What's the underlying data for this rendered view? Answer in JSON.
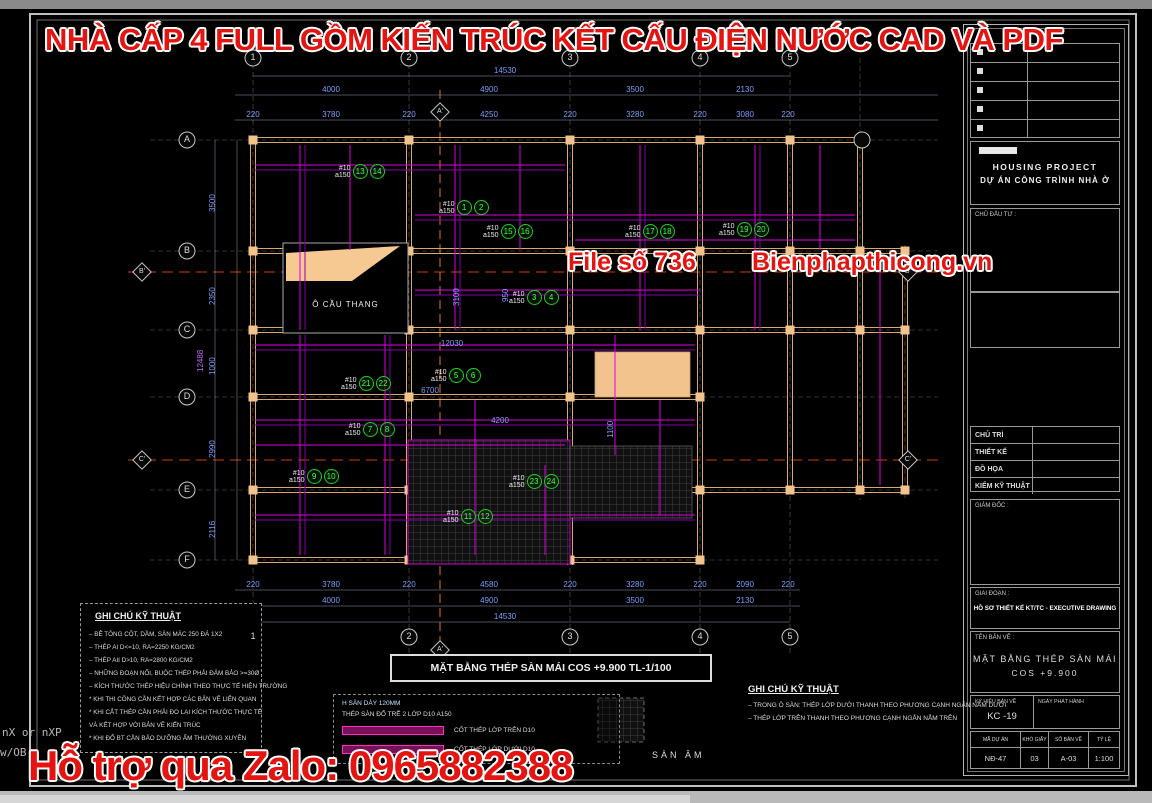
{
  "overlay": {
    "top_banner": "NHÀ CẤP 4 FULL GỒM KIẾN TRÚC KẾT CẤU ĐIỆN NƯỚC CAD VÀ PDF",
    "file_no": "File số 736",
    "website": "Bienphapthicong.vn",
    "zalo": "Hỗ trợ qua Zalo: 0965882388",
    "accent_red": "#e41410"
  },
  "terminal": {
    "line1": "nX or nXP",
    "line2": "w/OB"
  },
  "grid": {
    "cols": [
      "1",
      "2",
      "3",
      "4",
      "5"
    ],
    "rows": [
      "A",
      "B",
      "C",
      "D",
      "E",
      "F"
    ],
    "aux_col": "A'",
    "aux_rows": [
      "B'",
      "C'"
    ]
  },
  "dims": {
    "top_total": "14530",
    "top_spans": [
      "4000",
      "4900",
      "3500",
      "2130"
    ],
    "top_subs": [
      "220",
      "3780",
      "220",
      "4250",
      "220",
      "3280",
      "220",
      "3080",
      "220"
    ],
    "bottom_total": "14530",
    "bottom_spans": [
      "4000",
      "4900",
      "3500",
      "2130"
    ],
    "bottom_subs": [
      "220",
      "3780",
      "220",
      "4580",
      "220",
      "3280",
      "220",
      "2090",
      "220"
    ],
    "left_total": "12488",
    "left_spans": [
      "3500",
      "2350",
      "1000",
      "2990",
      "2116"
    ],
    "interior": [
      "12030",
      "6700",
      "4200",
      "1100",
      "3100",
      "950"
    ]
  },
  "callouts": {
    "bar": "#10",
    "spacing": "a150",
    "items": [
      {
        "a": "13",
        "b": "14"
      },
      {
        "a": "1",
        "b": "2"
      },
      {
        "a": "15",
        "b": "16"
      },
      {
        "a": "17",
        "b": "18"
      },
      {
        "a": "19",
        "b": "20"
      },
      {
        "a": "3",
        "b": "4"
      },
      {
        "a": "21",
        "b": "22"
      },
      {
        "a": "5",
        "b": "6"
      },
      {
        "a": "7",
        "b": "8"
      },
      {
        "a": "9",
        "b": "10"
      },
      {
        "a": "23",
        "b": "24"
      },
      {
        "a": "11",
        "b": "12"
      }
    ]
  },
  "plan": {
    "title": "MẶT BẰNG  THÉP  SÀN MÁI   COS +9.900    TL-1/100",
    "stair_label": "Ô CẦU THANG",
    "sunken_label": "SÀN  ÂM"
  },
  "legend": {
    "line1": "H SÀN DÀY 120MM",
    "line2": "THÉP SÀN ĐỔ TRỄ 2 LỚP D10 A150",
    "top_layer": "CỐT THÉP LỚP TRÊN D10",
    "bottom_layer": "CỐT THÉP LỚP DƯỚI D10"
  },
  "notes_left": {
    "title": "GHI CHÚ KỸ THUẬT",
    "lines": [
      "– BÊ TÔNG CỘT, DẦM, SÀN MÁC 250 ĐÁ 1X2",
      "– THÉP AI D<=10, RA=2250 KG/CM2",
      "– THÉP AII D>10, RA=2800 KG/CM2",
      "– NHỮNG ĐOẠN NỐI, BUỘC THÉP PHẢI ĐẢM BẢO >=30Ø",
      "– KÍCH THƯỚC THÉP HIỆU CHỈNH THEO THỰC TẾ HIỆN TRƯỜNG",
      "* KHI THI CÔNG CẦN KẾT HỢP CÁC BẢN VẼ LIÊN QUAN",
      "* KHI CẮT THÉP CẦN PHẢI ĐO LẠI KÍCH THƯỚC THỰC TẾ",
      "   VÀ KẾT HỢP VỚI BẢN VẼ KIẾN TRÚC",
      "* KHI ĐỔ BT CẦN BẢO DƯỠNG ẨM THƯỜNG XUYÊN"
    ]
  },
  "notes_right": {
    "title": "GHI CHÚ KỸ THUẬT",
    "lines": [
      "– TRONG Ô SÀN: THÉP LỚP DƯỚI THANH THEO PHƯƠNG CẠNH NGẮN NẰM DƯỚI",
      "– THÉP LỚP TRÊN THANH THEO PHƯƠNG CẠNH NGẮN NẰM TRÊN"
    ]
  },
  "titleblock": {
    "project_en": "HOUSING PROJECT",
    "project_vi": "DỰ ÁN CÔNG TRÌNH NHÀ Ở",
    "client": "CHỦ ĐẦU TƯ :",
    "roles": [
      "CHỦ TRÌ",
      "THIẾT KẾ",
      "ĐỒ HỌA",
      "KIỂM KỸ THUẬT"
    ],
    "director": "GIÁM ĐỐC :",
    "stage_label": "GIAI ĐOẠN :",
    "stage": "HỒ SƠ THIẾT KẾ KT/TC - EXECUTIVE DRAWING",
    "sheet_label": "TÊN BẢN VẼ :",
    "sheet_name": "MẶT BẰNG THÉP SÀN MÁI",
    "sheet_cos": "COS +9.900",
    "code_label": "KÝ HIỆU BẢN VẼ",
    "code": "KC -19",
    "date_label": "NGÀY PHÁT HÀNH",
    "footer": [
      {
        "label": "MÃ DỰ ÁN",
        "value": "NĐ-47"
      },
      {
        "label": "KHỔ GIẤY",
        "value": "03"
      },
      {
        "label": "SỐ BẢN VẼ",
        "value": "A-03"
      },
      {
        "label": "TỶ LỆ",
        "value": "1:100"
      }
    ]
  }
}
